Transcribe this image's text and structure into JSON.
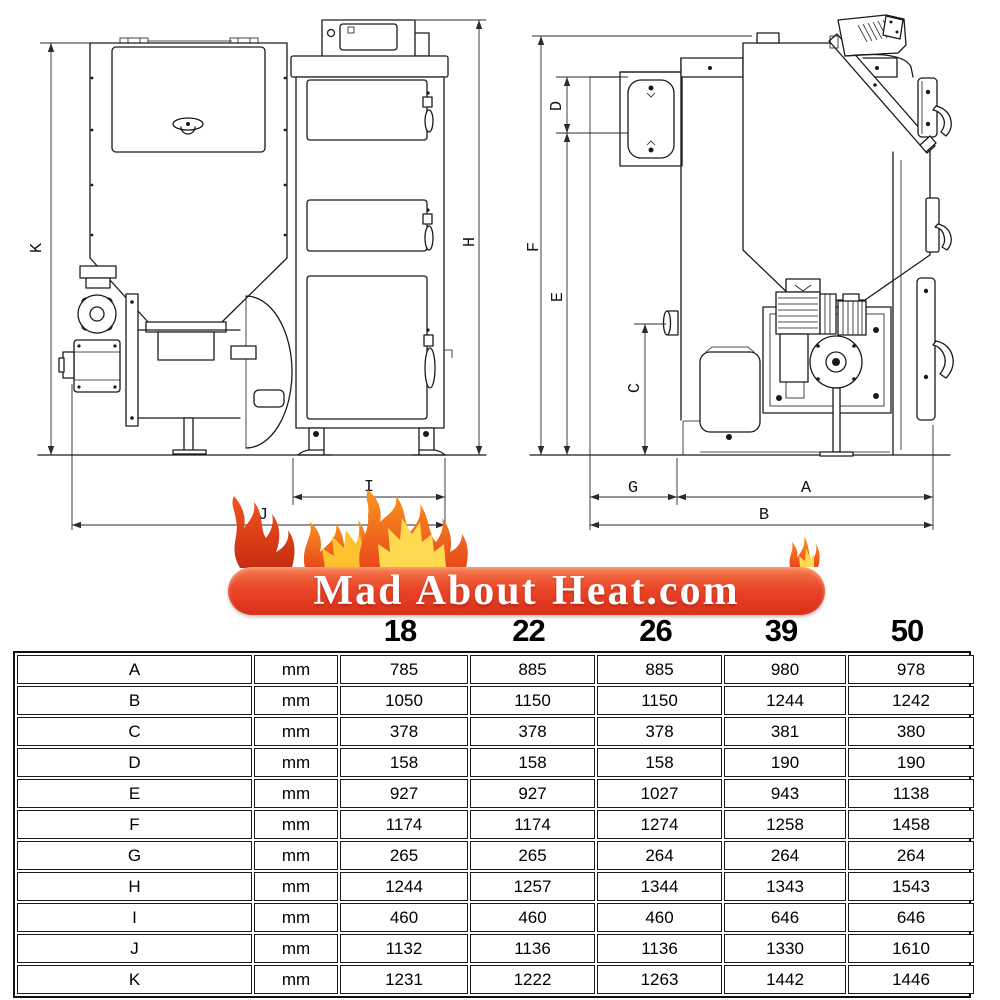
{
  "logo": {
    "text": "Mad About Heat.com"
  },
  "drawings": {
    "dims": {
      "A": "A",
      "B": "B",
      "C": "C",
      "D": "D",
      "E": "E",
      "F": "F",
      "G": "G",
      "H": "H",
      "I": "I",
      "J": "J",
      "K": "K"
    }
  },
  "table": {
    "models": [
      "18",
      "22",
      "26",
      "39",
      "50"
    ],
    "rows": [
      {
        "dim": "A",
        "unit": "mm",
        "values": [
          "785",
          "885",
          "885",
          "980",
          "978"
        ]
      },
      {
        "dim": "B",
        "unit": "mm",
        "values": [
          "1050",
          "1150",
          "1150",
          "1244",
          "1242"
        ]
      },
      {
        "dim": "C",
        "unit": "mm",
        "values": [
          "378",
          "378",
          "378",
          "381",
          "380"
        ]
      },
      {
        "dim": "D",
        "unit": "mm",
        "values": [
          "158",
          "158",
          "158",
          "190",
          "190"
        ]
      },
      {
        "dim": "E",
        "unit": "mm",
        "values": [
          "927",
          "927",
          "1027",
          "943",
          "1138"
        ]
      },
      {
        "dim": "F",
        "unit": "mm",
        "values": [
          "1174",
          "1174",
          "1274",
          "1258",
          "1458"
        ]
      },
      {
        "dim": "G",
        "unit": "mm",
        "values": [
          "265",
          "265",
          "264",
          "264",
          "264"
        ]
      },
      {
        "dim": "H",
        "unit": "mm",
        "values": [
          "1244",
          "1257",
          "1344",
          "1343",
          "1543"
        ]
      },
      {
        "dim": "I",
        "unit": "mm",
        "values": [
          "460",
          "460",
          "460",
          "646",
          "646"
        ]
      },
      {
        "dim": "J",
        "unit": "mm",
        "values": [
          "1132",
          "1136",
          "1136",
          "1330",
          "1610"
        ]
      },
      {
        "dim": "K",
        "unit": "mm",
        "values": [
          "1231",
          "1222",
          "1263",
          "1442",
          "1446"
        ]
      }
    ]
  },
  "colors": {
    "banner_top": "#f57a50",
    "banner_mid": "#ea4629",
    "banner_bottom": "#d92f1a",
    "flame_red": "#e0401b",
    "flame_orange": "#f47b20",
    "flame_yellow": "#ffd94f",
    "line": "#1a1a1a",
    "text": "#111111"
  }
}
